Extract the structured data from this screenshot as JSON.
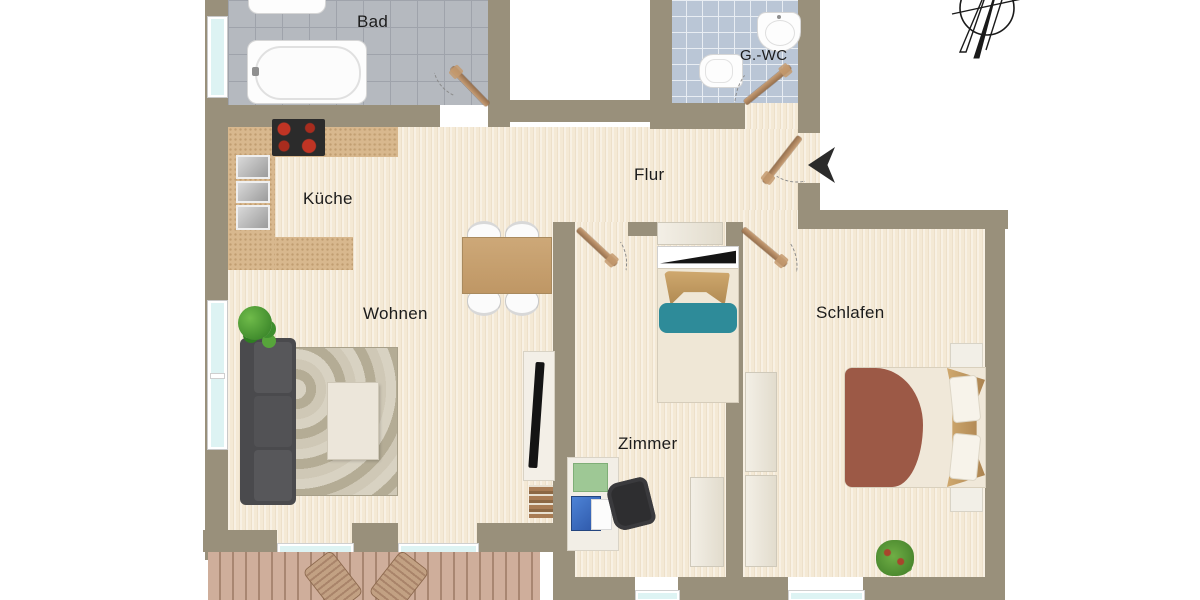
{
  "plan": {
    "type": "apartment-floorplan",
    "rooms": {
      "bad": {
        "label": "Bad"
      },
      "gwc": {
        "label": "G.-WC"
      },
      "flur": {
        "label": "Flur"
      },
      "kueche": {
        "label": "Küche"
      },
      "wohnen": {
        "label": "Wohnen"
      },
      "zimmer": {
        "label": "Zimmer"
      },
      "schlafen": {
        "label": "Schlafen"
      }
    },
    "colors": {
      "wall": "#99907b",
      "floor": "#f4e9d5",
      "bad_tiles": "#b5b9bf",
      "gwc_tiles": "#bac6d6",
      "counter": "#d8b88e",
      "door_leaf": "#b08968",
      "sofa": "#4a4a4d",
      "bed_blanket": "#9c5946",
      "pillow_teal": "#2e8b99",
      "deck": "#cfae9b",
      "window_glass": "#ddf3f3",
      "entrance_arrow": "#2b2b2b"
    },
    "icons": {
      "compass": "compass-rose-icon",
      "entrance": "entrance-arrow-icon"
    }
  }
}
